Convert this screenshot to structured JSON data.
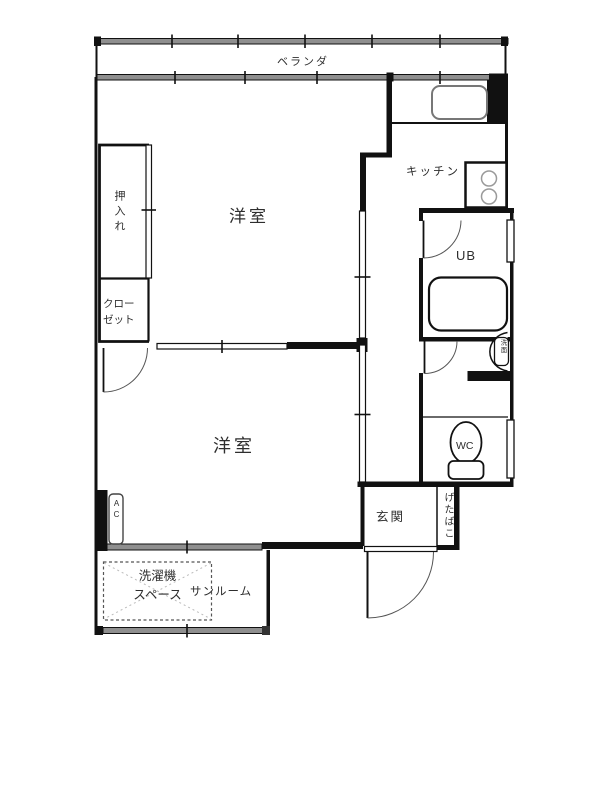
{
  "floorplan": {
    "labels": {
      "balcony": "ベランダ",
      "oshiire": "押入れ",
      "upper_room": "洋室",
      "kitchen": "キッチン",
      "unit_bath": "UB",
      "closet_line1": "クロー",
      "closet_line2": "ゼット",
      "washbasin": "洗面",
      "wc": "WC",
      "lower_room": "洋室",
      "entrance": "玄関",
      "shoe_cabinet": "げたばこ",
      "ac": "AC",
      "washer_line1": "洗濯機",
      "washer_line2": "スペース",
      "sunroom": "サンルーム"
    },
    "colors": {
      "wall": "#111111",
      "window_fill": "#8f8f8f",
      "label_text": "#2e2e2e"
    }
  }
}
